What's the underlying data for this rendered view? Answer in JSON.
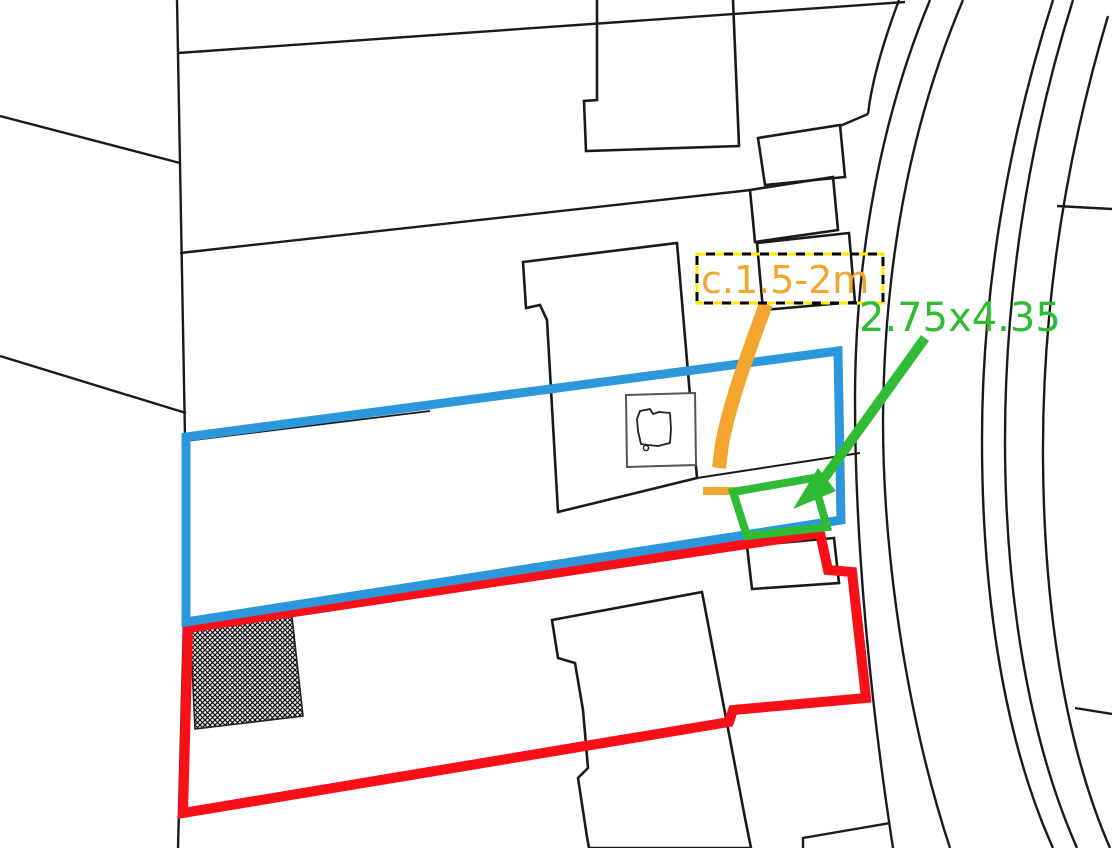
{
  "map": {
    "kind": "cadastral site plan with survey annotations",
    "labels": {
      "gap_annotation": {
        "text": "c.1.5-2m"
      },
      "dimension_annotation": {
        "text": "2.75x4.35"
      }
    },
    "colors": {
      "orange_annotation": "#F2A52F",
      "green_annotation": "#2FBC34",
      "blue_boundary": "#2D97DC",
      "red_boundary": "#FA0F19",
      "parcel_line": "#1A1A1A",
      "label_box_dash_black": "#000000",
      "label_box_dash_yellow": "#FFE900",
      "background": "#FFFFFF"
    }
  }
}
